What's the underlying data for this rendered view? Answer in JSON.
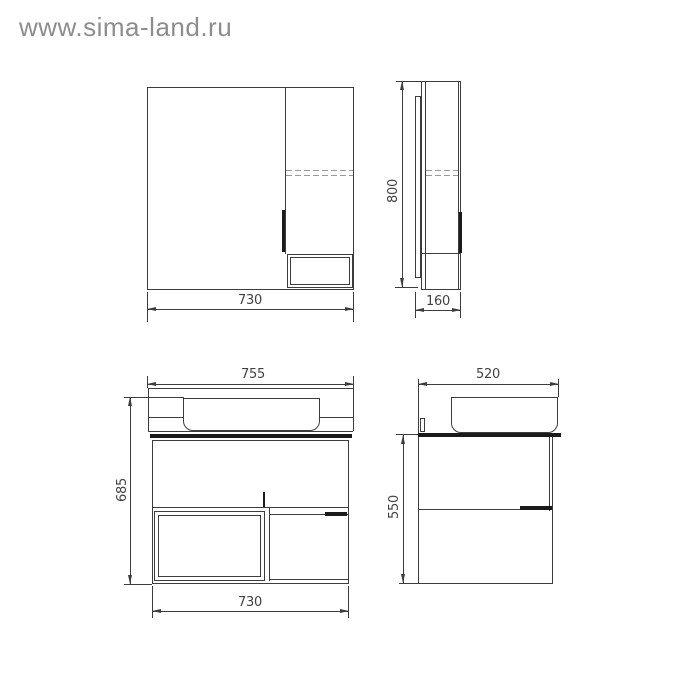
{
  "watermark": "www.sima-land.ru",
  "drawing": {
    "type": "technical-drawing",
    "subject": "bathroom mirror cabinet and vanity unit, four orthographic views with dimensions (mm)",
    "views": {
      "mirror_cabinet_front": {
        "width_label": "730"
      },
      "mirror_cabinet_side": {
        "height_label": "800",
        "depth_label": "160"
      },
      "vanity_front": {
        "top_width_label": "755",
        "height_label": "685",
        "bottom_width_label": "730"
      },
      "vanity_side": {
        "depth_label": "520",
        "height_label": "550"
      }
    }
  },
  "colors": {
    "background": "#ffffff",
    "line": "#3d3d3d",
    "dashed_line": "#9a9a9a",
    "handle_fill": "#1b1b1b",
    "dim_text": "#424242",
    "watermark_text": "#8d8d8d"
  }
}
